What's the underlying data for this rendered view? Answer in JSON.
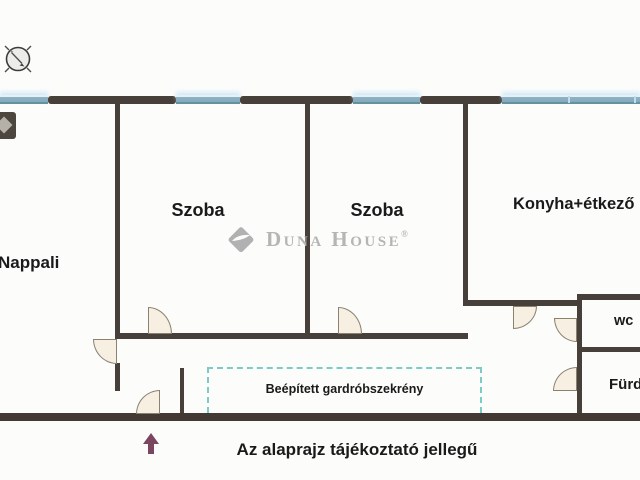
{
  "plan": {
    "rooms": [
      {
        "id": "nappali",
        "label": "Nappali"
      },
      {
        "id": "szoba1",
        "label": "Szoba"
      },
      {
        "id": "szoba2",
        "label": "Szoba"
      },
      {
        "id": "konyha",
        "label": "Konyha+étkező"
      },
      {
        "id": "wc",
        "label": "wc"
      },
      {
        "id": "furdo",
        "label": "Fürdő"
      }
    ],
    "wardrobe_label": "Beépített gardróbszekrény",
    "disclaimer": "Az alaprajz tájékoztató jellegű"
  },
  "watermark": {
    "brand": "Duna House",
    "registered": "®"
  },
  "icons": {
    "compass": "compass-icon",
    "stamp": "duna-diamond-icon",
    "entrance": "entrance-arrow-icon"
  },
  "colors": {
    "wall": "#473f39",
    "window_teal": "#84aabd",
    "wardrobe_dash": "#7ccbc9",
    "door_fill": "#f7f0e2",
    "entrance_arrow": "#7a4660",
    "watermark_gray": "#b5b5b5"
  }
}
